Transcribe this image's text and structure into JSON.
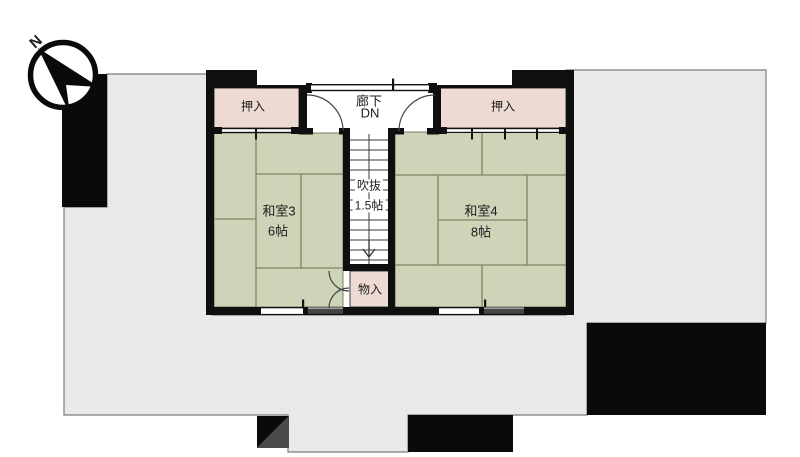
{
  "compass": {
    "label": "N"
  },
  "rooms": {
    "oshiire_left": {
      "label": "押入"
    },
    "oshiire_right": {
      "label": "押入"
    },
    "rouka": {
      "label": "廊下",
      "direction": "DN"
    },
    "washitsu3": {
      "label": "和室3",
      "size": "6帖"
    },
    "washitsu4": {
      "label": "和室4",
      "size": "8帖"
    },
    "fukinuke": {
      "label": "吹抜",
      "size": "1.5帖"
    },
    "monoire": {
      "label": "物入"
    }
  },
  "colors": {
    "tatami_green": "#ced4b8",
    "closet_pink": "#eddbd3",
    "roof_gray": "#e9e9e7",
    "wall_black": "#0f0f0f",
    "site_dark_gray": "#4a4a4a"
  }
}
